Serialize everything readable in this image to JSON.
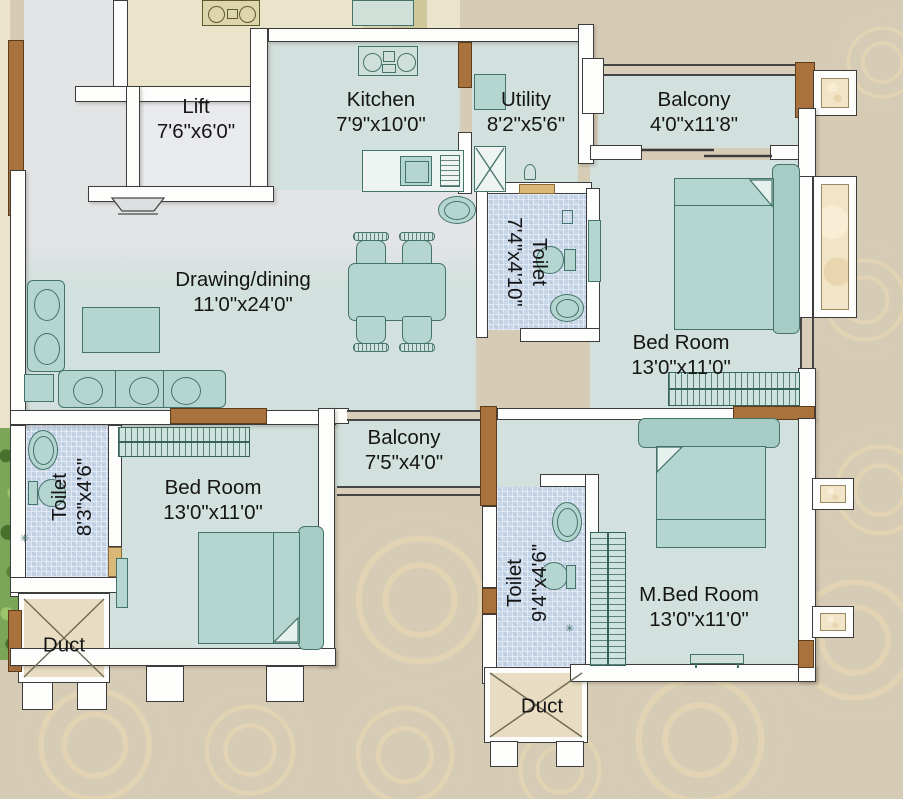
{
  "rooms": [
    {
      "id": "lift",
      "name": "Lift",
      "dims": "7'6\"x6'0\""
    },
    {
      "id": "kitchen",
      "name": "Kitchen",
      "dims": "7'9\"x10'0\""
    },
    {
      "id": "utility",
      "name": "Utility",
      "dims": "8'2\"x5'6\""
    },
    {
      "id": "balcony-top",
      "name": "Balcony",
      "dims": "4'0\"x11'8\""
    },
    {
      "id": "drawing-dining",
      "name": "Drawing/dining",
      "dims": "11'0\"x24'0\""
    },
    {
      "id": "toilet-1",
      "name": "Toilet",
      "dims": "7'4\"x4'10\""
    },
    {
      "id": "bedroom-right",
      "name": "Bed Room",
      "dims": "13'0\"x11'0\""
    },
    {
      "id": "balcony-middle",
      "name": "Balcony",
      "dims": "7'5\"x4'0\""
    },
    {
      "id": "toilet-2",
      "name": "Toilet",
      "dims": "8'3\"x4'6\""
    },
    {
      "id": "bedroom-left",
      "name": "Bed Room",
      "dims": "13'0\"x11'0\""
    },
    {
      "id": "toilet-3",
      "name": "Toilet",
      "dims": "9'4\"x4'6\""
    },
    {
      "id": "master-bedroom",
      "name": "M.Bed Room",
      "dims": "13'0\"x11'0\""
    },
    {
      "id": "duct-1",
      "name": "Duct"
    },
    {
      "id": "duct-2",
      "name": "Duct"
    }
  ],
  "colors": {
    "outside": "#d6ccb6",
    "swirl": "#ecdcb2",
    "interior_floor": "#d2e1dd",
    "entry_gray": "#e2e4e5",
    "lift_floor": "#e9eaed",
    "toilet_tile": "#c7d6e8",
    "wall": "#fdfdfc",
    "wall_outline": "#3c3c3c",
    "wood": "#a9713c",
    "furniture": "#b5d6d0",
    "furniture_outline": "#44736a",
    "neighbor_floor": "#ebe4ca",
    "label_text": "#151515"
  }
}
